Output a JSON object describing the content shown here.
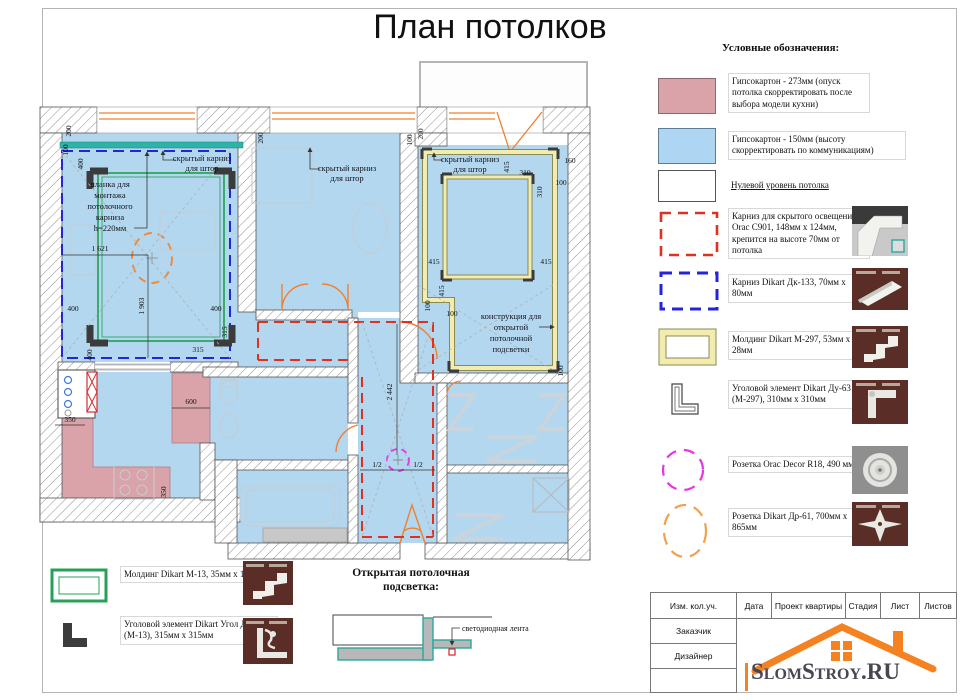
{
  "title": "План потолков",
  "legend": {
    "heading": "Условные обозначения:",
    "items": [
      {
        "swatch": "pink-solid",
        "label": "Гипсокартон - 273мм (опуск потолка скорректировать после выбора модели кухни)"
      },
      {
        "swatch": "blue-solid",
        "label": "Гипсокартон - 150мм (высоту скорректировать по коммуникациям)"
      },
      {
        "swatch": "white-solid",
        "label": "Нулевой уровень потолка"
      },
      {
        "swatch": "red-dashed",
        "label": "Карниз для скрытого освещения Orac C901, 148мм x 124мм, крепится на высоте 70мм от потолка"
      },
      {
        "swatch": "blue-dashed",
        "label": "Карниз Dikart Дк-133, 70мм x 80мм"
      },
      {
        "swatch": "yellow-frame",
        "label": "Молдинг Dikart М-297, 53мм x 28мм"
      },
      {
        "swatch": "corner-glyph",
        "label": "Уголовой элемент Dikart Ду-63 (М-297), 310мм x 310мм"
      },
      {
        "swatch": "magenta-circle",
        "label": "Розетка Orac Decor R18, 490 мм"
      },
      {
        "swatch": "orange-ellipse",
        "label": "Розетка Dikart Др-61, 700мм x 865мм"
      }
    ],
    "extra": [
      {
        "swatch": "green-frame",
        "label": "Молдинг Dikart М-13, 35мм x 15мм"
      },
      {
        "swatch": "corner-solid",
        "label": "Уголовой элемент Dikart Угол Ду-51 (М-13), 315мм x 315мм"
      }
    ]
  },
  "detail": {
    "heading1": "Открытая потолочная",
    "heading2": "подсветка:",
    "led": "светодиодная лента"
  },
  "plan": {
    "curtain": [
      "скрытый карниз",
      "для штор"
    ],
    "plank": [
      "планка для",
      "монтажа",
      "потолочного",
      "карниза",
      "h=220мм"
    ],
    "construct": [
      "конструкция для",
      "открытой",
      "потолочной",
      "подсветки"
    ],
    "dims": {
      "d1621": "1 621",
      "d1903": "1 903",
      "d2442": "2 442",
      "d400": "400",
      "d315": "315",
      "d200": "200",
      "d100": "100",
      "d415": "415",
      "d310": "310",
      "d160": "160",
      "d600": "600",
      "d350": "350",
      "dhalf": "1/2"
    }
  },
  "titleblock": {
    "h": [
      "Изм. кол.уч.",
      "Дата",
      "Проект квартиры",
      "Стадия",
      "Лист",
      "Листов"
    ],
    "r1": "Заказчик",
    "r2": "Дизайнер",
    "logo": "SlomStroy.RU"
  },
  "colors": {
    "blue_fill": "#b3d7ef",
    "pink_fill": "#d9a3a9",
    "red_dash": "#e03020",
    "blue_dash": "#2424d8",
    "green": "#1f9e4f",
    "teal": "#2fb3a8",
    "magenta": "#e832e8",
    "yellow_band": "#f2ecae",
    "accent_orange": "#f08030"
  }
}
